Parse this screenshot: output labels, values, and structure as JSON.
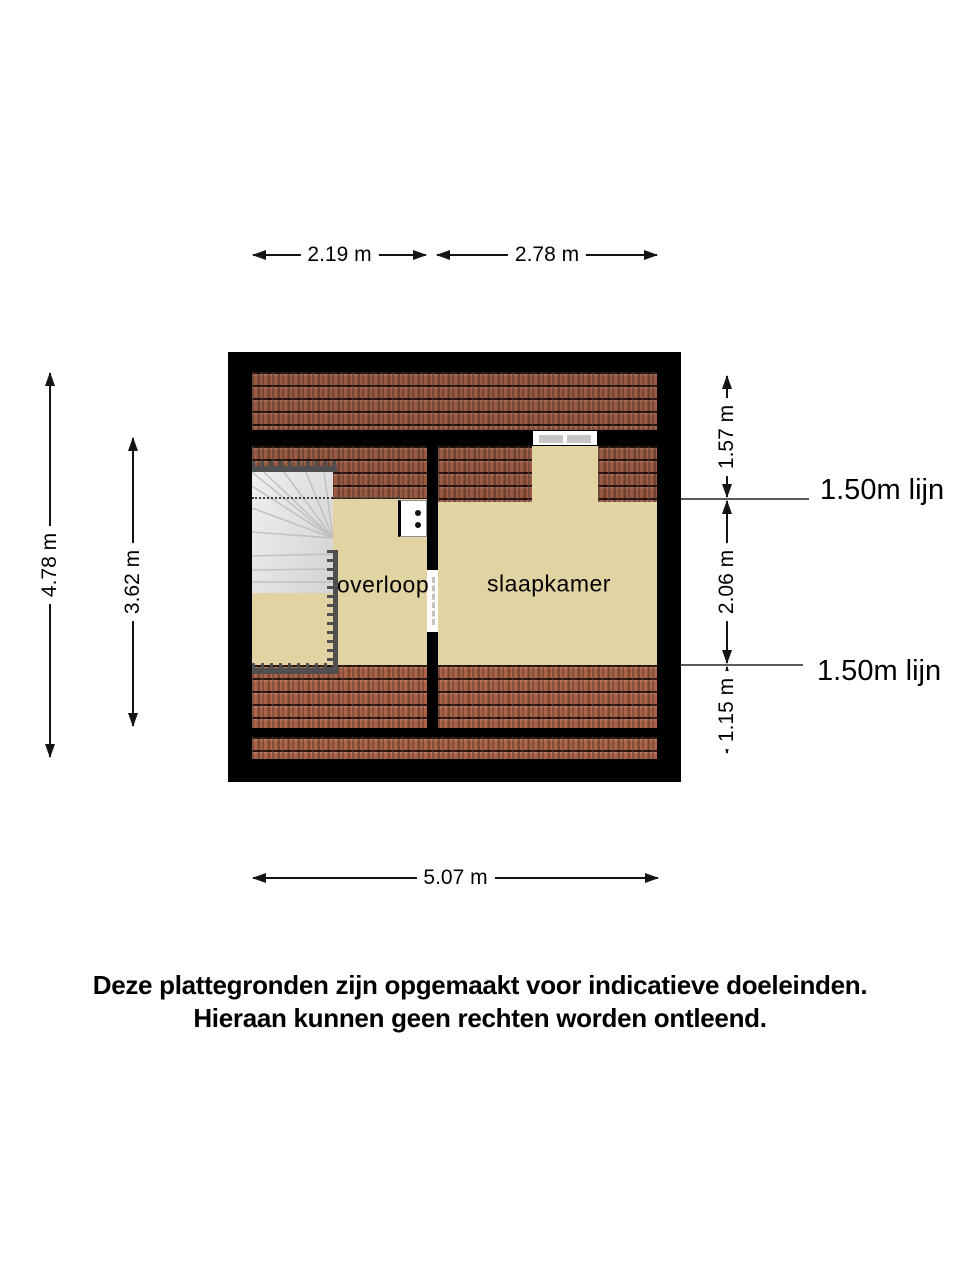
{
  "plan": {
    "rooms": {
      "overloop": "overloop",
      "slaapkamer": "slaapkamer"
    },
    "dims": {
      "top_left": "2.19 m",
      "top_right": "2.78 m",
      "bottom": "5.07 m",
      "left_outer": "4.78 m",
      "left_inner": "3.62 m",
      "right_top": "1.57 m",
      "right_mid": "2.06 m",
      "right_bottom": "1.15 m"
    },
    "ref_lines": {
      "top": "1.50m lijn",
      "bottom": "1.50m lijn"
    },
    "colors": {
      "wall": "#000000",
      "roof_tile": "#9a5a42",
      "floor": "#e2d3a2",
      "railing": "#4f4f4f"
    }
  },
  "disclaimer": {
    "line1": "Deze plattegronden zijn opgemaakt voor indicatieve doeleinden.",
    "line2": "Hieraan kunnen geen rechten worden ontleend."
  }
}
